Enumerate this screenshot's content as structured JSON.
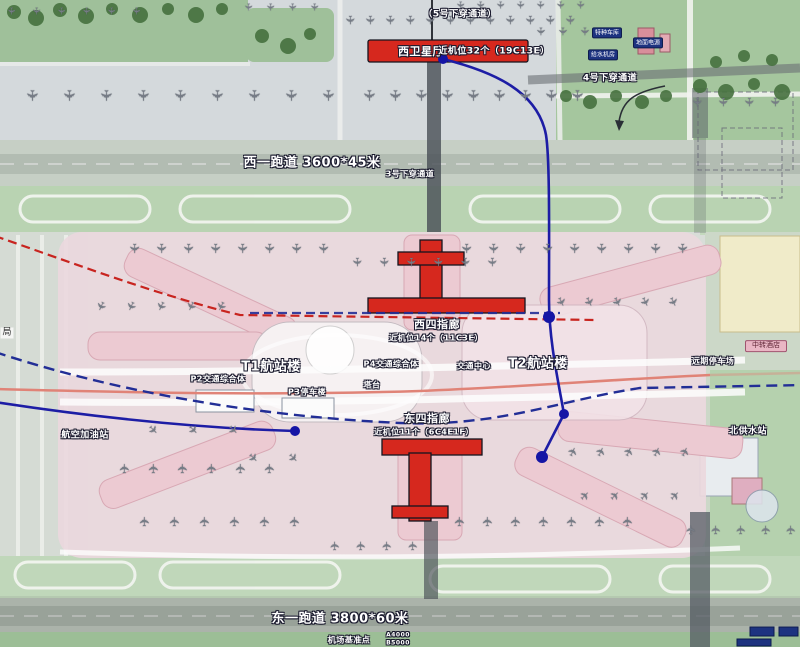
{
  "map": {
    "description": "airport master plan",
    "labels": {
      "tunnel5": "（5号下穿通道）",
      "west_satellite": "西卫星厅",
      "west_satellite_stands": "近机位32个（19C13E）",
      "tunnel4": "4号下穿通道",
      "runway_west": "西一跑道 3600*45米",
      "tunnel3": "3号下穿通道",
      "west_pier": "西四指廊",
      "west_pier_stands": "近机位14个（11C3E）",
      "t1": "T1航站楼",
      "t2": "T2航站楼",
      "p2": "P2交通综合体",
      "p3": "P3停车楼",
      "p4": "P4交通综合体",
      "traffic_center": "交通中心",
      "tower": "塔台",
      "east_pier": "东四指廊",
      "east_pier_stands": "近机位11个（6C4E1F）",
      "fuel_station": "航空加油站",
      "north_water": "北供水站",
      "far_parking": "远期停车场",
      "hotel": "中转酒店",
      "runway_east": "东一跑道 3800*60米",
      "datum": "机场基准点",
      "datum_a": "A4000",
      "datum_b": "B5000",
      "special_garage": "特种车库",
      "ground_power": "地面电源",
      "water_room": "给水机房",
      "left_partial": "局"
    },
    "colors": {
      "terminal_red": "#d6281e",
      "pier_pink": "#eccad2",
      "terminal_wash": "#ead8dd",
      "metro_blue": "#1d1da5",
      "metro_blue_dashed": "#222e96",
      "rail_red_dashed": "#c8241f",
      "road_salmon": "#e08377",
      "green_dark": "#46713f",
      "green_band": "#9fc09a",
      "runway_grey": "#b2bcb2"
    },
    "icons": {
      "aircraft": "✈"
    },
    "aircraft_rows": [
      {
        "x": 6,
        "y": 6,
        "dx": 25,
        "n": 6,
        "s": 10,
        "r": 90
      },
      {
        "x": 243,
        "y": 2,
        "dx": 22,
        "n": 4,
        "s": 10,
        "r": 90
      },
      {
        "x": 345,
        "y": 14,
        "dx": 20,
        "n": 12,
        "s": 12,
        "r": 90
      },
      {
        "x": 455,
        "y": 0,
        "dx": 20,
        "n": 7,
        "s": 10,
        "r": 90
      },
      {
        "x": 536,
        "y": 26,
        "dx": 22,
        "n": 3,
        "s": 11,
        "r": 90
      },
      {
        "x": 25,
        "y": 88,
        "dx": 37,
        "n": 9,
        "s": 15,
        "r": 90
      },
      {
        "x": 362,
        "y": 88,
        "dx": 26,
        "n": 9,
        "s": 15,
        "r": 90
      },
      {
        "x": 692,
        "y": 96,
        "dx": 26,
        "n": 4,
        "s": 12,
        "r": 90
      },
      {
        "x": 128,
        "y": 242,
        "dx": 27,
        "n": 8,
        "s": 13,
        "r": 90
      },
      {
        "x": 460,
        "y": 242,
        "dx": 27,
        "n": 9,
        "s": 13,
        "r": 90
      },
      {
        "x": 352,
        "y": 256,
        "dx": 27,
        "n": 6,
        "s": 12,
        "r": 90
      },
      {
        "x": 96,
        "y": 300,
        "dx": 30,
        "n": 5,
        "s": 12,
        "r": 115
      },
      {
        "x": 556,
        "y": 296,
        "dx": 28,
        "n": 5,
        "s": 12,
        "r": 65
      },
      {
        "x": 120,
        "y": 462,
        "dx": 29,
        "n": 6,
        "s": 13,
        "r": -90
      },
      {
        "x": 140,
        "y": 515,
        "dx": 30,
        "n": 6,
        "s": 13,
        "r": -90
      },
      {
        "x": 455,
        "y": 515,
        "dx": 28,
        "n": 7,
        "s": 13,
        "r": -90
      },
      {
        "x": 330,
        "y": 540,
        "dx": 26,
        "n": 4,
        "s": 12,
        "r": -90
      },
      {
        "x": 568,
        "y": 446,
        "dx": 28,
        "n": 5,
        "s": 12,
        "r": -65
      },
      {
        "x": 580,
        "y": 490,
        "dx": 30,
        "n": 4,
        "s": 12,
        "r": -45
      },
      {
        "x": 686,
        "y": 524,
        "dx": 25,
        "n": 5,
        "s": 12,
        "r": -90
      },
      {
        "x": 148,
        "y": 424,
        "dx": 40,
        "n": 3,
        "s": 12,
        "r": 45
      },
      {
        "x": 248,
        "y": 452,
        "dx": 40,
        "n": 2,
        "s": 12,
        "r": 45
      }
    ]
  }
}
